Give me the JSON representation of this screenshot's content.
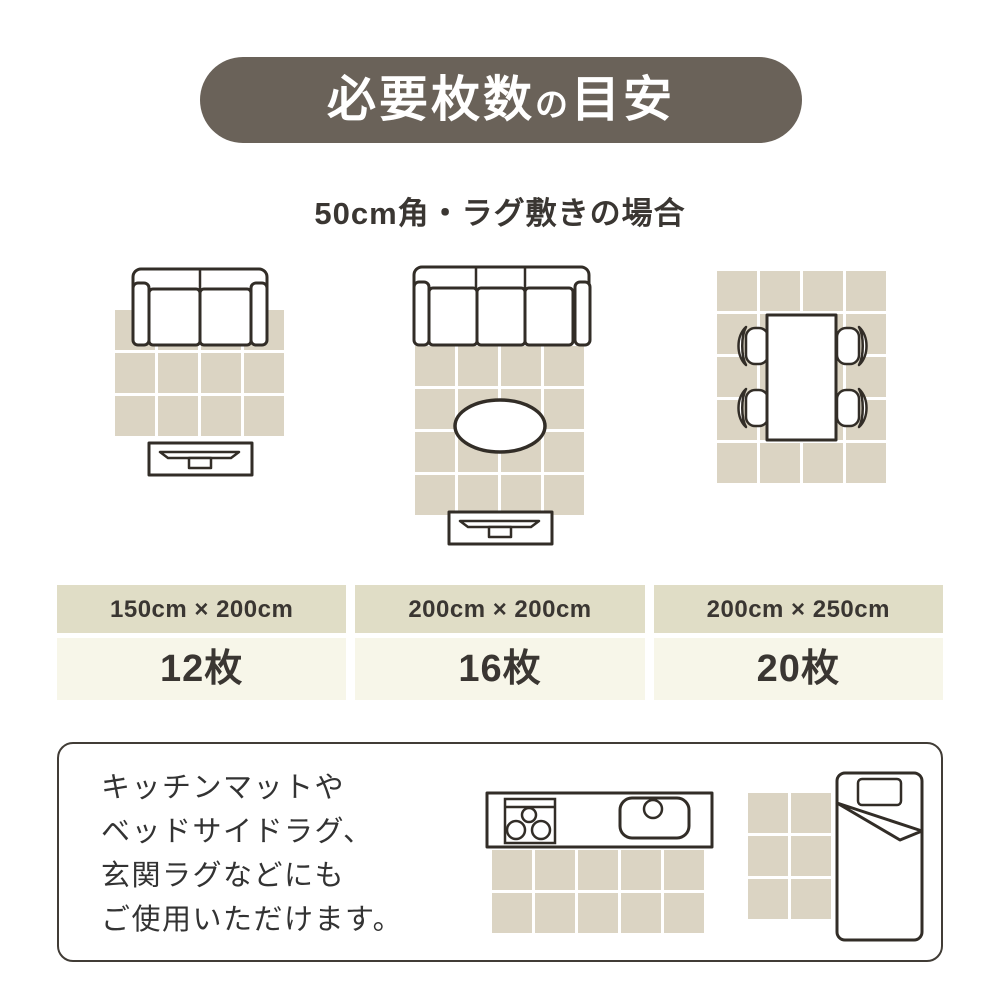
{
  "page": {
    "title": {
      "main": "必要枚数",
      "particle": "の",
      "rest": "目安"
    },
    "subtitle": "50cm角・ラグ敷きの場合"
  },
  "colors": {
    "badge": "#6a6259",
    "tile": "#dbd4c3",
    "header_bg": "#e0ddc6",
    "value_bg": "#f7f6e9",
    "line": "#322d27",
    "text": "#3a3632"
  },
  "illustrations": [
    {
      "label": "living room with 2-seat sofa and TV stand",
      "tiles": {
        "cols": 4,
        "rows": 3
      }
    },
    {
      "label": "living room with 3-seat sofa, oval table and TV stand",
      "tiles": {
        "cols": 4,
        "rows": 4
      }
    },
    {
      "label": "dining table with four chairs",
      "tiles": {
        "cols": 4,
        "rows": 5
      }
    },
    {
      "label": "kitchen counter mat",
      "tiles": {
        "cols": 5,
        "rows": 2
      }
    },
    {
      "label": "bedside rug",
      "tiles": {
        "cols": 2,
        "rows": 3
      }
    }
  ],
  "size_table": {
    "columns": [
      {
        "size": "150cm × 200cm",
        "count": "12枚"
      },
      {
        "size": "200cm × 200cm",
        "count": "16枚"
      },
      {
        "size": "200cm × 250cm",
        "count": "20枚"
      }
    ]
  },
  "note": {
    "lines": [
      "キッチンマットや",
      "ベッドサイドラグ、",
      "玄関ラグなどにも",
      "ご使用いただけます。"
    ]
  }
}
